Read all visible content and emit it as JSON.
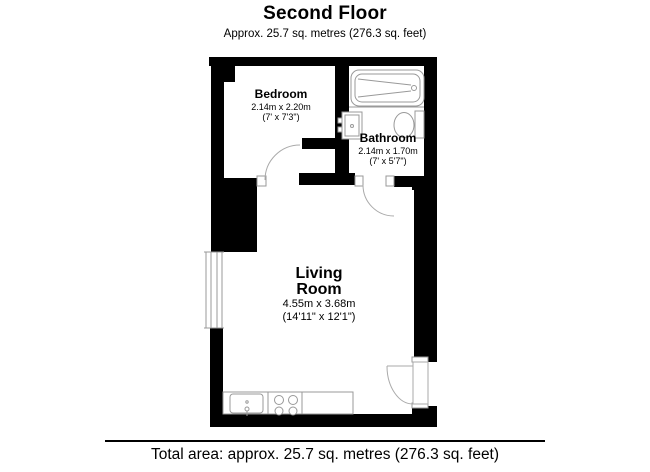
{
  "header": {
    "title": "Second Floor",
    "subtitle": "Approx. 25.7 sq. metres (276.3 sq. feet)"
  },
  "rooms": [
    {
      "name": "Bedroom",
      "dimensions_metric": "2.14m x 2.20m",
      "dimensions_imperial": "(7' x 7'3\")"
    },
    {
      "name": "Bathroom",
      "dimensions_metric": "2.14m x 1.70m",
      "dimensions_imperial": "(7' x 5'7\")"
    },
    {
      "name": "Living Room",
      "name_lines": [
        "Living",
        "Room"
      ],
      "dimensions_metric": "4.55m x 3.68m",
      "dimensions_imperial": "(14'11\" x 12'1\")"
    }
  ],
  "fixtures": [
    "bathtub",
    "toilet",
    "basin",
    "window",
    "kitchen-counter",
    "kitchen-sink",
    "hob",
    "entry-door",
    "bedroom-door",
    "bathroom-door"
  ],
  "footer": {
    "total_area": "Total area: approx. 25.7 sq. metres (276.3 sq. feet)"
  },
  "colors": {
    "background": "#ffffff",
    "walls": "#000000",
    "fixture_outline": "#999999",
    "text": "#000000"
  }
}
